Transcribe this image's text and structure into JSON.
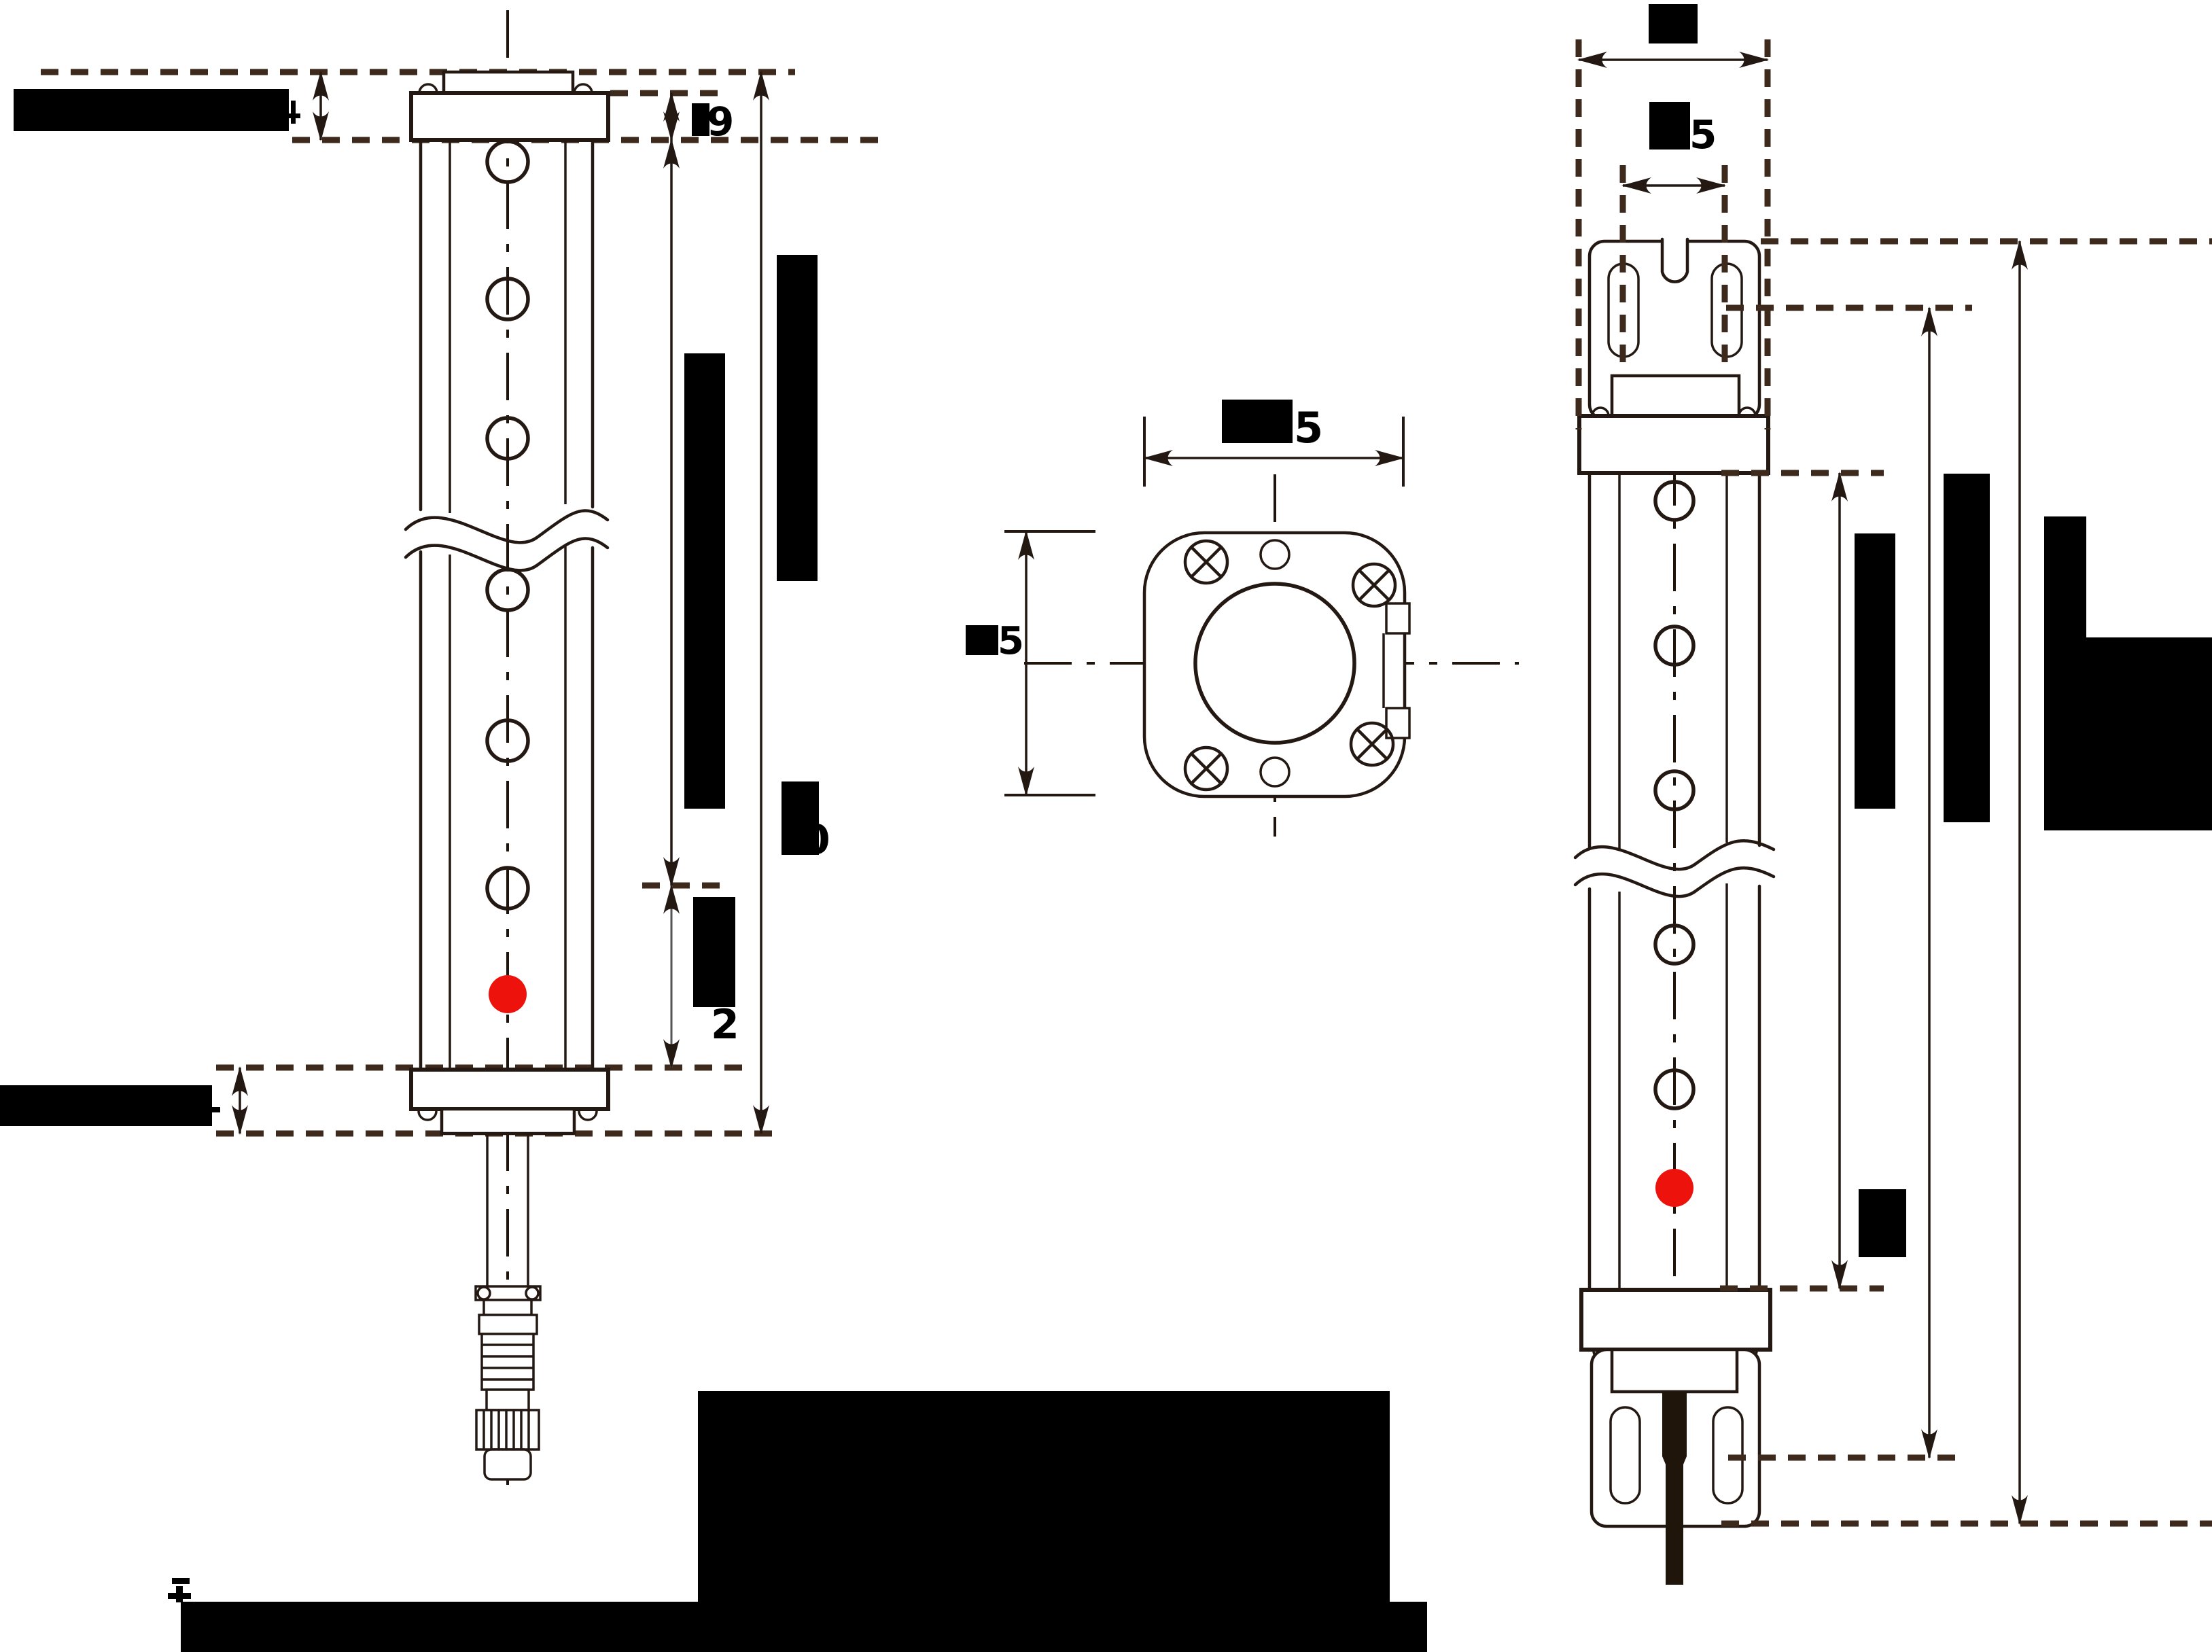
{
  "title": "sensor-dimension-drawing",
  "colors": {
    "background": "#ffffff",
    "line": "#241813",
    "dashed_line": "#3d2a1c",
    "redaction": "#000000",
    "beam_dot": "#ed120b",
    "thin_dim": "#555555"
  },
  "labels": {
    "front": {
      "cap_height": "9",
      "total_height": "0",
      "lower_zone": "2"
    },
    "section": {
      "width": "5",
      "height": "5"
    },
    "side": {
      "hole_pitch": "5"
    }
  }
}
